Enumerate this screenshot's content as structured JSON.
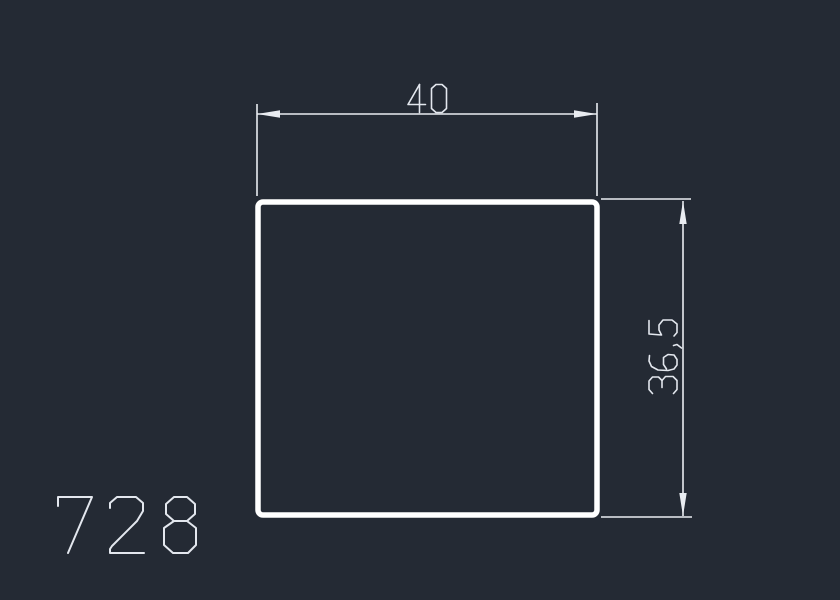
{
  "document": {
    "type": "cad-profile-drawing",
    "part": {
      "number": "728"
    },
    "profile": {
      "shape": "square tube profile",
      "width_mm": 40,
      "height_mm": 36.5
    },
    "dimension_labels": {
      "width": "40",
      "height": "36,5"
    }
  },
  "colors": {
    "background": "#242a34",
    "outline": "#ffffff",
    "dimension": "#e9ecf1",
    "text": "#e3e7ee"
  }
}
